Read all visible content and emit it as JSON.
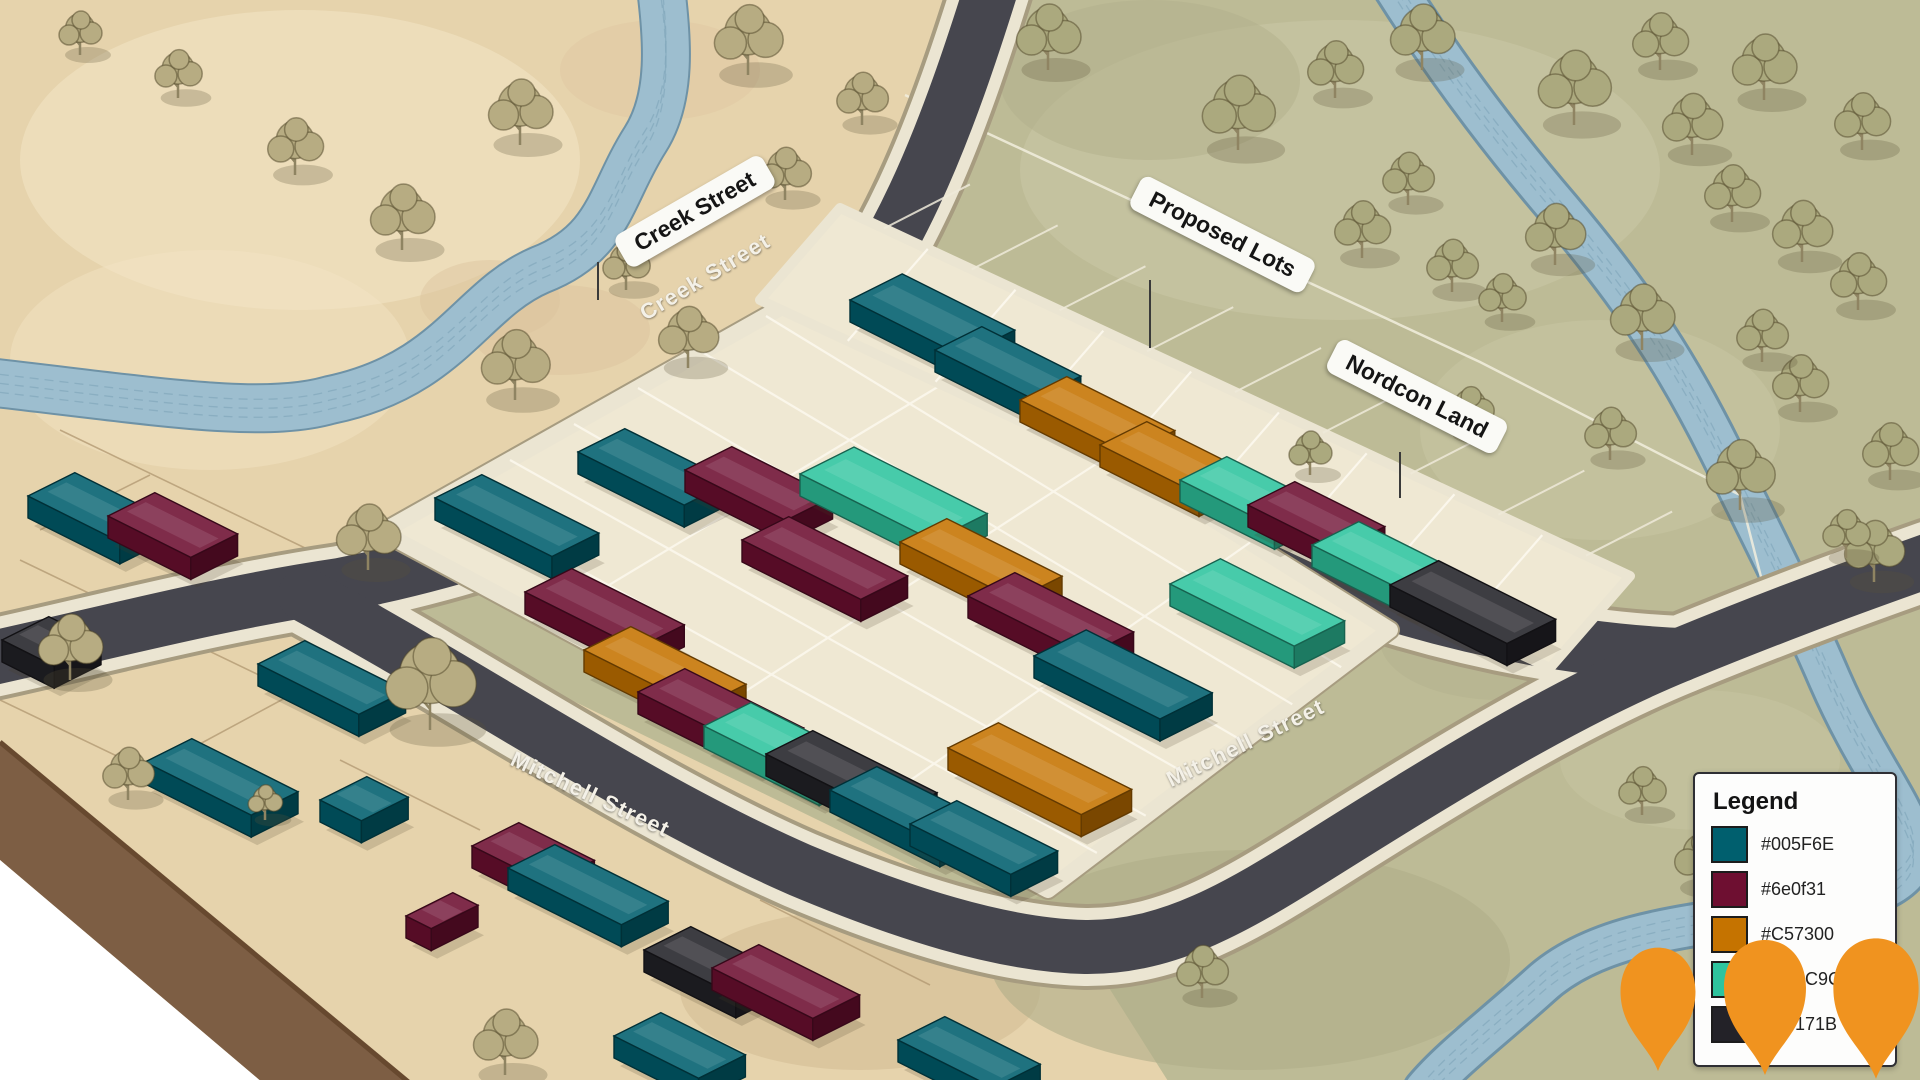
{
  "labels": {
    "creek_street_sign": "Creek Street",
    "creek_street_road": "Creek Street",
    "mitchell_street_road_west": "Mitchell Street",
    "mitchell_street_road_east": "Mitchell Street",
    "proposed_lots_sign": "Proposed Lots",
    "nordcon_land_sign": "Nordcon Land"
  },
  "legend": {
    "title": "Legend",
    "items": [
      {
        "swatch": "#005F6E",
        "label": "#005F6E",
        "occluded": false
      },
      {
        "swatch": "#6e0f31",
        "label": "#6e0f31",
        "occluded": false
      },
      {
        "swatch": "#C57300",
        "label": "#C57300",
        "occluded": false
      },
      {
        "swatch": "#2EC49E",
        "label": "3C9C",
        "occluded": true
      },
      {
        "swatch": "#232228",
        "label": "171B",
        "occluded": true
      }
    ]
  },
  "markers": {
    "shape": "map-pin",
    "color": "#F0931F",
    "count": 3
  },
  "palette": {
    "teal": "#005F6E",
    "maroon": "#6e0f31",
    "orange": "#C57300",
    "mint": "#2EC49E",
    "dark": "#232228"
  },
  "houses": {
    "central": [
      [
        "teal",
        435,
        498,
        130
      ],
      [
        "teal",
        578,
        452,
        118
      ],
      [
        "maroon",
        685,
        470,
        112
      ],
      [
        "maroon",
        742,
        540,
        132
      ],
      [
        "maroon",
        525,
        592,
        125
      ],
      [
        "orange",
        584,
        650,
        128
      ],
      [
        "maroon",
        638,
        692,
        132
      ],
      [
        "mint",
        704,
        726,
        128
      ],
      [
        "dark",
        766,
        754,
        138
      ],
      [
        "teal",
        830,
        790,
        122
      ],
      [
        "teal",
        910,
        824,
        112
      ],
      [
        "mint",
        800,
        474,
        148,
        60
      ],
      [
        "orange",
        900,
        542,
        128
      ],
      [
        "maroon",
        968,
        596,
        132
      ],
      [
        "teal",
        1034,
        656,
        140,
        58
      ],
      [
        "mint",
        1170,
        584,
        138,
        56
      ],
      [
        "orange",
        948,
        748,
        148,
        56
      ]
    ],
    "proposed": [
      [
        "teal",
        850,
        300,
        125,
        58
      ],
      [
        "teal",
        935,
        350,
        110
      ],
      [
        "orange",
        1020,
        400,
        120
      ],
      [
        "orange",
        1100,
        445,
        110
      ],
      [
        "mint",
        1180,
        480,
        105
      ],
      [
        "maroon",
        1248,
        505,
        100
      ],
      [
        "mint",
        1312,
        545,
        110
      ],
      [
        "dark",
        1390,
        585,
        130,
        54
      ]
    ],
    "existing": [
      [
        "teal",
        28,
        496,
        102
      ],
      [
        "maroon",
        108,
        516,
        92
      ],
      [
        "dark",
        2,
        640,
        58
      ],
      [
        "teal",
        258,
        664,
        112
      ],
      [
        "teal",
        145,
        762,
        118
      ],
      [
        "teal",
        320,
        800,
        46
      ],
      [
        "maroon",
        472,
        846,
        84
      ],
      [
        "teal",
        508,
        868,
        126
      ],
      [
        "dark",
        644,
        950,
        102
      ],
      [
        "maroon",
        712,
        968,
        112
      ],
      [
        "teal",
        614,
        1036,
        94
      ],
      [
        "maroon",
        406,
        916,
        28
      ],
      [
        "teal",
        898,
        1040,
        106
      ]
    ]
  }
}
